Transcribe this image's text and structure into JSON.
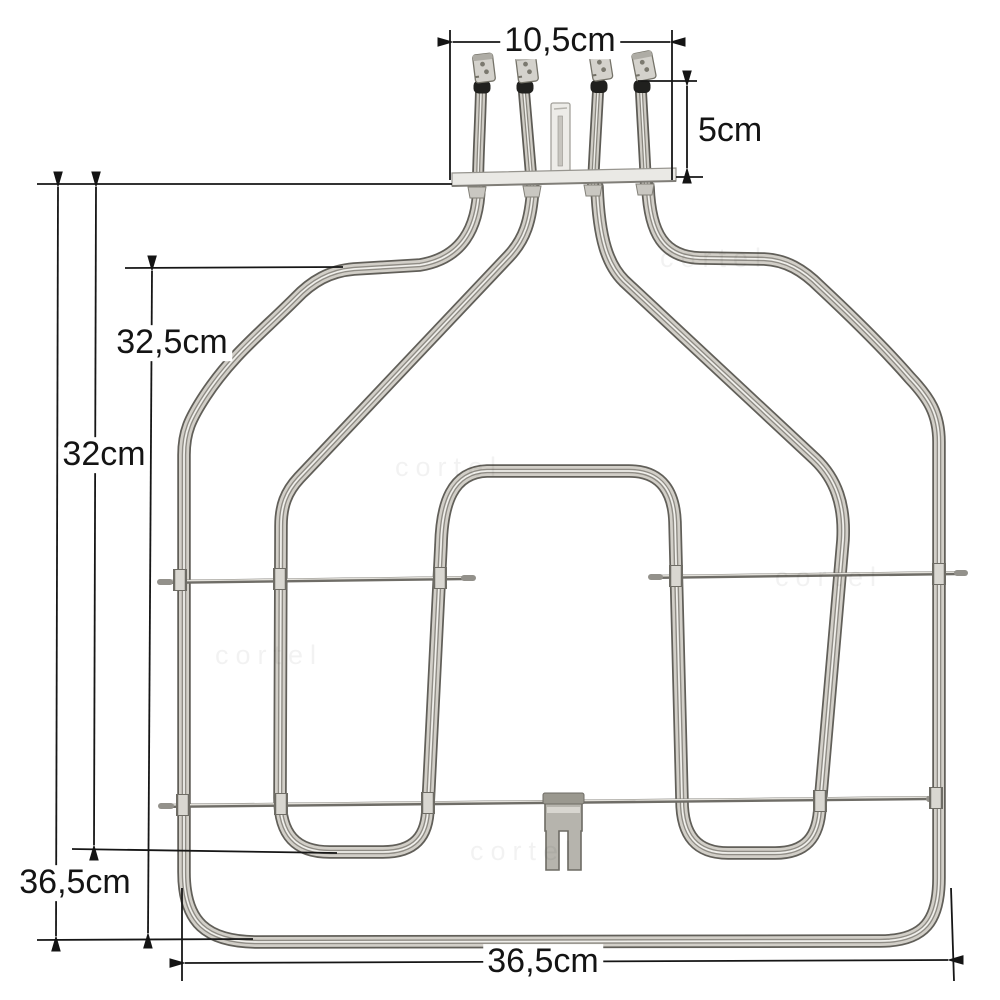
{
  "figure": {
    "type": "product-dimension-photo",
    "subject": "Oven grill heating element with terminal flange, support rods and mounting bracket",
    "background_color": "#ffffff",
    "annotation_color": "#161616",
    "metal_light": "#d2cfc8",
    "metal_dark": "#615f59"
  },
  "dimensions": {
    "terminal_block_width": "10,5cm",
    "terminal_pin_height": "5cm",
    "upper_bend_to_bottom_height": "32,5cm",
    "flange_to_inner_loop_height": "32cm",
    "total_height": "36,5cm",
    "overall_width": "36,5cm"
  },
  "watermark": {
    "text": "cortel"
  }
}
